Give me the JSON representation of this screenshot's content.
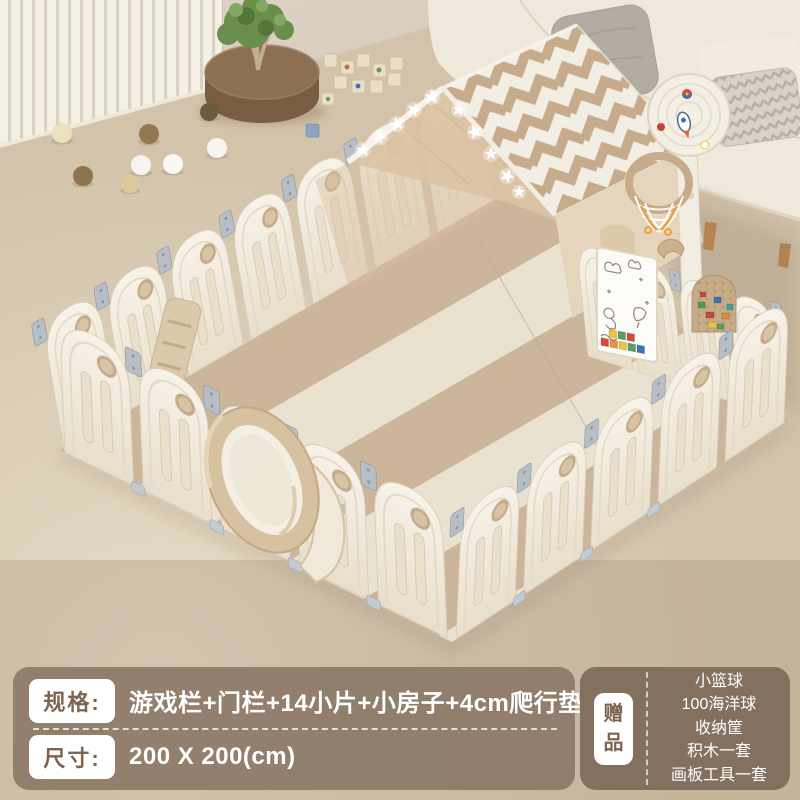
{
  "info_panel": {
    "spec": {
      "label": "规格:",
      "value": "游戏栏+门栏+14小片+小房子+4cm爬行垫"
    },
    "size": {
      "label": "尺寸:",
      "value": "200 X 200(cm)"
    },
    "gift": {
      "label": "赠品",
      "items": [
        "小篮球",
        "100海洋球",
        "收纳筐",
        "积木一套",
        "画板工具一套"
      ]
    }
  },
  "colors": {
    "spec-panel-bg": "rgba(139,120,103,0.9)",
    "gift-panel-bg": "rgba(126,107,90,0.94)",
    "badge-bg": "#ffffff",
    "badge-text": "#7c6451",
    "panel-text": "#ffffff",
    "fence-cream": "#f5efe2",
    "mat-tan": "#c9b093",
    "mat-cream": "#e9e0cd",
    "roof-chevron-tan": "#c7ab8d",
    "floor-beige": "#d5c5ae",
    "wall-beige": "#d8cec1",
    "ottoman-brown": "#84664c",
    "sofa-cream": "#efe9dc",
    "hinge-gray": "#b7bec6"
  }
}
